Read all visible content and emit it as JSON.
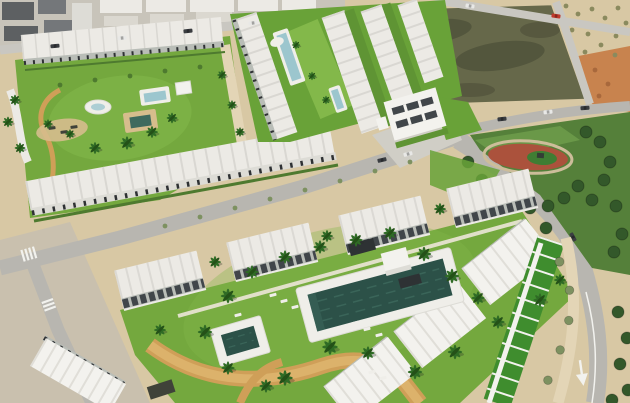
{
  "meta": {
    "title": "Aerial 3D render of a new-build residential development",
    "description": "Bird's-eye architectural visualization: white modern apartment and townhouse complexes with communal swimming pools, bright lawns, palm trees and sandy paths, beside an existing town, a vacant plot, access roads and a public park with a circular playground."
  },
  "colors": {
    "sand": "#d8c8a4",
    "sand_light": "#e3d5b6",
    "ground_gray": "#c9c0ae",
    "dirt_orange": "#c8834e",
    "dirt_dot": "#a8683c",
    "road": "#b8b6b0",
    "road_light": "#c9c7c1",
    "sidewalk": "#d0cec6",
    "marking_white": "#f2f2ee",
    "lawn": "#74a83e",
    "lawn_mid": "#69a238",
    "lawn_light": "#83b84a",
    "turf": "#3f8d2e",
    "garden_green": "#5f9434",
    "park_green": "#55803a",
    "park_light": "#6d9a4a",
    "tree_dark": "#33582a",
    "tree_olive": "#7d9160",
    "shrub_olive": "#8a8a5e",
    "palm_green": "#2f6b25",
    "palm_dark": "#245118",
    "hedge": "#4e7a2f",
    "building_white": "#f3f2ee",
    "building_shade": "#dddcd6",
    "facade_gray": "#b9bdb7",
    "facade_dark": "#41464a",
    "window_dark": "#2e3133",
    "roof_white": "#eceae5",
    "roof_line": "#d7d5cf",
    "town_base": "#c8c4ba",
    "town_roof_dark": "#5d6062",
    "town_roof_mid": "#74777a",
    "town_roof_light": "#dedcd4",
    "pool_dark": "#2c5148",
    "pool_streak": "#3e6a5e",
    "pool_light": "#9cc6ce",
    "deck_white": "#efeee9",
    "deck_sand": "#d6bd8d",
    "path_tan": "#cf9f58",
    "path_tan_light": "#dcb26b",
    "path_white": "#ece6d8",
    "lot_olive": "#66684a",
    "lot_dark": "#4c4e38",
    "playground_red": "#ab523c",
    "playground_green": "#3f7d33",
    "playground_path": "#cdbd9a",
    "structure_dark": "#333d35",
    "pergola_dark": "#2e3234",
    "pergola_gray": "#3f4239",
    "car_red": "#c03a2b",
    "car_white": "#e8e8e6",
    "car_dark": "#3a3d41",
    "shadow": "rgba(40,45,35,0.3)"
  },
  "scene": {
    "existing_town": {
      "label": "Existing town streets and rooftops"
    },
    "sand_terrain": {
      "label": "Sandy undeveloped terrain with shrubs"
    },
    "vacant_lot": {
      "label": "Vacant overgrown building plot"
    },
    "roads": {
      "label": "Access roads with crosswalks and lane arrow"
    },
    "park": {
      "label": "Public park with trees and circular playground"
    },
    "north_complex": {
      "label": "Townhouse complex with oval feature and two small pools"
    },
    "central_complex": {
      "label": "Townhouse rows with long communal lap pool"
    },
    "corner_building": {
      "label": "Modern corner apartment building"
    },
    "main_complex": {
      "label": "New apartment complex with large communal pool, lawn and palms"
    },
    "vegetation": {
      "label": "Palm trees and park trees"
    },
    "furniture": {
      "label": "Sun loungers"
    },
    "vehicles": {
      "label": "Cars on streets"
    }
  }
}
